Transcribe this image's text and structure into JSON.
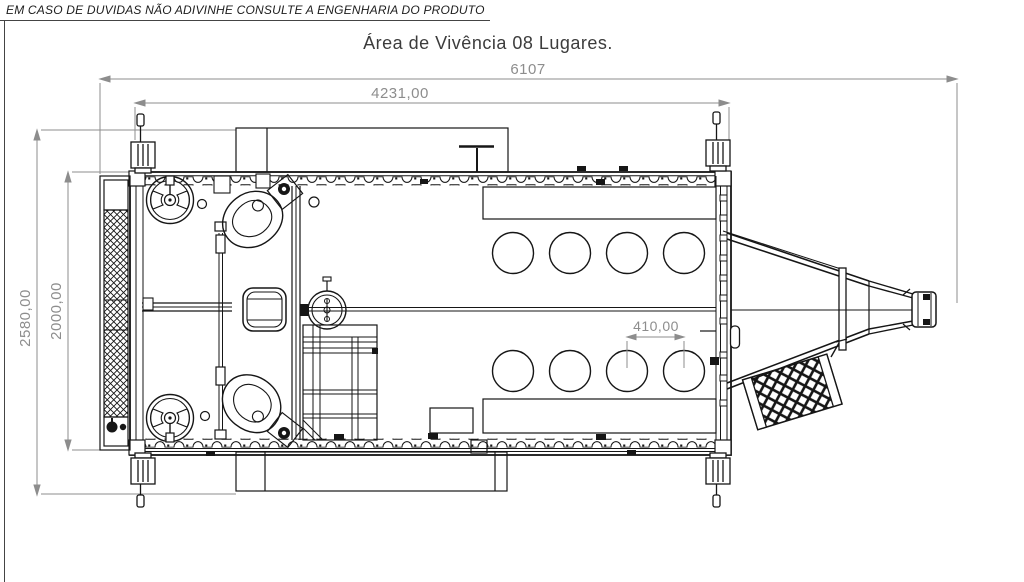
{
  "drawing_frame": {
    "warning_note": "EM CASO DE DUVIDAS NÃO ADIVINHE CONSULTE A ENGENHARIA DO PRODUTO",
    "title": "Área de Vivência 08 Lugares."
  },
  "dimensions": {
    "overall_length": "6107",
    "body_length": "4231,00",
    "overall_width": "2580,00",
    "body_width": "2000,00",
    "seat_pitch": "410,00"
  },
  "plan": {
    "seat_count": 8,
    "colors": {
      "line": "#161616",
      "dimension": "#8d8d8d",
      "background": "#ffffff"
    }
  }
}
